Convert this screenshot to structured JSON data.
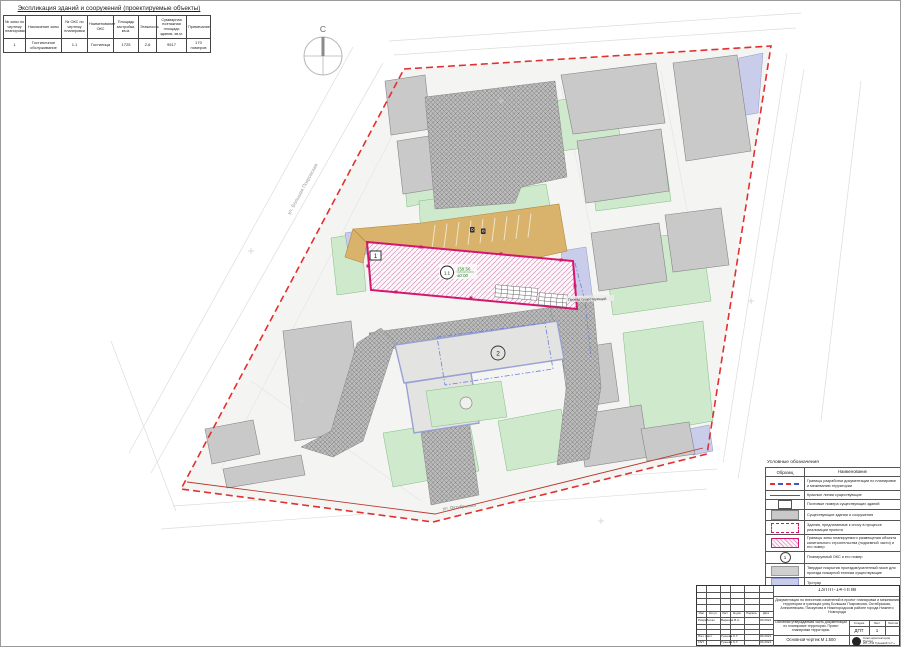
{
  "explication": {
    "title": "Экспликация зданий и сооружений (проектируемые объекты)",
    "headers": [
      "№ зоны по чертежу планировки",
      "Назначение зоны",
      "№ ОКС по чертежу планировки",
      "Наименование ОКС",
      "Площадь застройки, кв.м.",
      "Этажность",
      "Суммарная поэтажная площадь здания, кв.м.",
      "Примечание"
    ],
    "row": {
      "zone_no": "1",
      "zone_purpose": "Гостиничное обслуживание",
      "oks_no": "1.1",
      "oks_name": "Гостиница",
      "area": "1725",
      "floors": "2-6",
      "total_area": "9517",
      "note": "170 номеров"
    }
  },
  "plan": {
    "north_label": "С",
    "zone_box_label": "1",
    "oks_circle_label": "1.1",
    "elevation_top": "159.56",
    "elevation_bottom": "±0.00",
    "building2_label": "2",
    "road_label": "Проезд существующий",
    "street_left": "ул. Большая Покровская",
    "street_bottom": "ул. Октябрьская"
  },
  "legend": {
    "title": "Условные обозначения",
    "col_sample": "Образец",
    "col_name": "Наименование",
    "circle_sample": "1",
    "rows": [
      {
        "name": "Границы разработки документации по планировке и межеванию территории"
      },
      {
        "name": "Красные линии существующие"
      },
      {
        "name": "Почтовые номера существующих зданий"
      },
      {
        "name": "Существующие здания и сооружения"
      },
      {
        "name": "Здания, предлагаемые к сносу в процессе реализации проекта"
      },
      {
        "name": "Границы зоны планируемого размещения объекта капитального строительства (подземной части) и его номер"
      },
      {
        "name": "Планируемый ОКС и его номер"
      },
      {
        "name": "Твердые покрытия проездов/усиленный газон для проезда пожарной техники существующие"
      },
      {
        "name": "Тротуар"
      },
      {
        "name": "Газон"
      },
      {
        "name": "Проектируемый проезд"
      }
    ]
  },
  "stamp": {
    "code": "13/ПП-14-ППм",
    "description": "Документация по внесению изменений в проект планировки и межевания территории в границах улиц Большая Покровская, Октябрьская, Алексеевская, Пискунова в Нижегородском районе города Нижнего Новгорода",
    "change_headers": [
      "Изм.",
      "Кол.уч",
      "Лист",
      "№ док.",
      "Подпись",
      "Дата"
    ],
    "roles": [
      {
        "role": "Разработал",
        "name": "Варенов В.А.",
        "date": "03.2021"
      },
      {
        "role": "Нач. маст.",
        "name": "Гузеева С.Г.",
        "date": "03.2021"
      },
      {
        "role": "ГАП",
        "name": "Гузеева С.Г.",
        "date": "03.2021"
      }
    ],
    "section_title": "Основная утверждаемая часть документации по планировке территории. Проект планировки территории.",
    "stage_label": "Стадия",
    "sheet_label": "Лист",
    "sheets_label": "Листов",
    "stage": "ДПТ",
    "sheet": "1",
    "drawing_label": "Основной чертеж М 1:500",
    "org_line1": "Союз архитекторов России",
    "org_line2": "ИП «ТМ Гузеевой С.Г.»"
  },
  "colors": {
    "development_boundary": "#e23030",
    "red_line": "#b83a2e",
    "planned_building": "#d4166e",
    "lawn": "#cfe9cd",
    "sidewalk": "#c9cdea",
    "parking": "#d9b26b",
    "existing_building": "#c9c9c9"
  }
}
